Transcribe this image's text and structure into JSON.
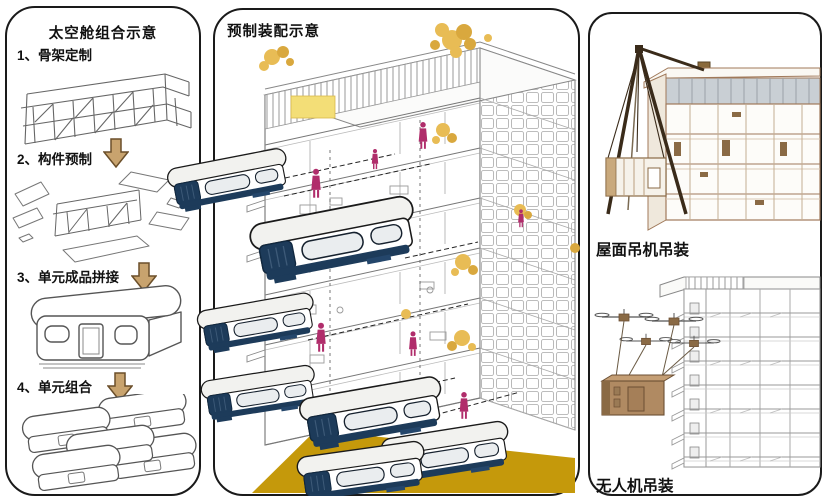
{
  "colors": {
    "gold": "#C5990B",
    "tree_yellow": "#E8BC55",
    "tree_dark": "#D9A83E",
    "magenta": "#B02D6B",
    "capsule_navy": "#1D3B5A",
    "arrow_tan": "#C8A36E",
    "crane_brown": "#3A2B1A",
    "building_tan": "#A0795A",
    "module_brown": "#B08A62",
    "panel_border": "#1A1A1A"
  },
  "left_panel": {
    "title": "太空舱组合示意",
    "steps": [
      {
        "num_label": "1、骨架定制"
      },
      {
        "num_label": "2、构件预制"
      },
      {
        "num_label": "3、单元成品拼接"
      },
      {
        "num_label": "4、单元组合"
      }
    ]
  },
  "middle_panel": {
    "title": "预制装配示意"
  },
  "right_panel": {
    "top_label": "屋面吊机吊装",
    "bottom_label": "无人机吊装"
  }
}
